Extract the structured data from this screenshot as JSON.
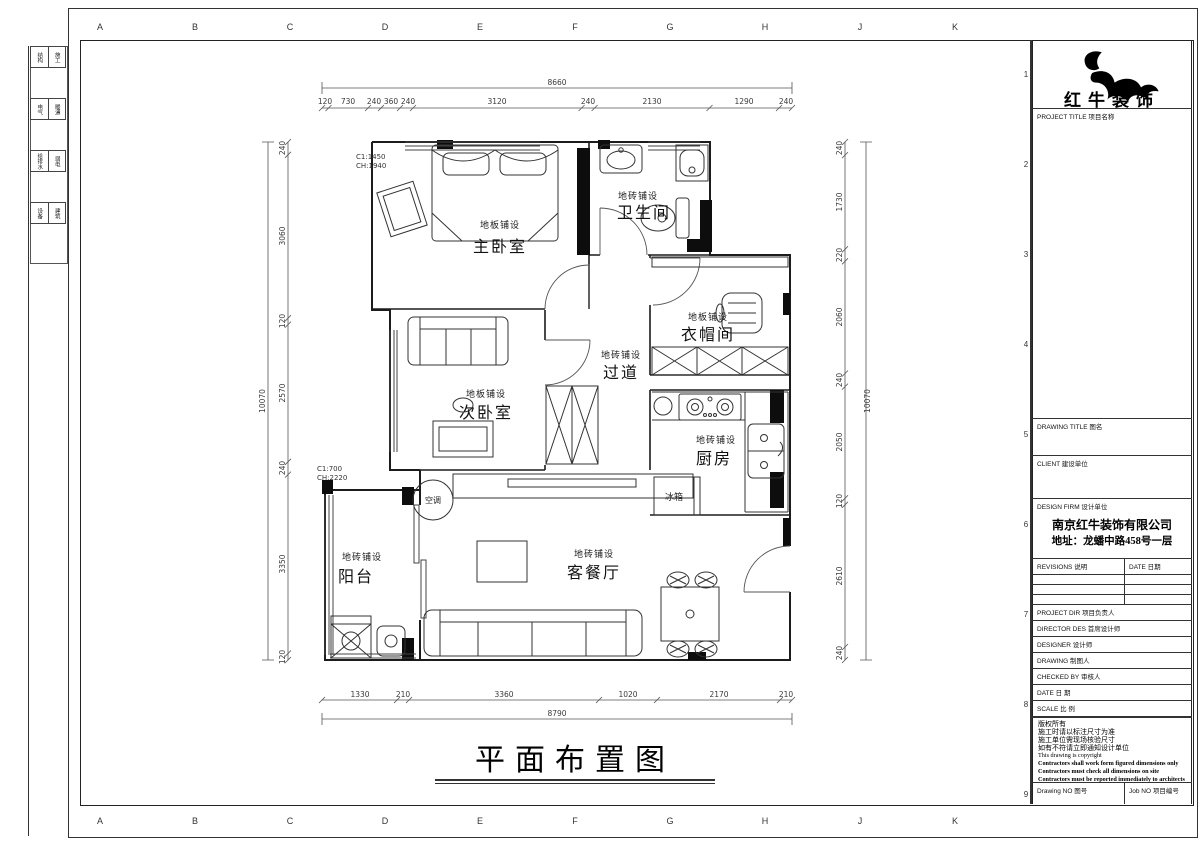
{
  "sheet": {
    "grid_letters": [
      "A",
      "B",
      "C",
      "D",
      "E",
      "F",
      "G",
      "H",
      "J",
      "K"
    ],
    "grid_numbers": [
      "1",
      "2",
      "3",
      "4",
      "5",
      "6",
      "7",
      "8",
      "9"
    ],
    "disciplines": [
      {
        "a": "结构",
        "b": "施工"
      },
      {
        "a": "电气",
        "b": "暖通"
      },
      {
        "a": "给排水",
        "b": "弱电"
      },
      {
        "a": "设备",
        "b": "建筑"
      }
    ],
    "main_title": "平面布置图"
  },
  "plan": {
    "rooms": [
      {
        "sub": "地板铺设",
        "name": "主卧室"
      },
      {
        "sub": "地砖铺设",
        "name": "卫生间"
      },
      {
        "sub": "地板铺设",
        "name": "衣帽间"
      },
      {
        "sub": "地砖铺设",
        "name": "过道"
      },
      {
        "sub": "地板铺设",
        "name": "次卧室"
      },
      {
        "sub": "地砖铺设",
        "name": "厨房"
      },
      {
        "sub": "地砖铺设",
        "name": "客餐厅"
      },
      {
        "sub": "地砖铺设",
        "name": "阳台"
      }
    ],
    "annotations": {
      "win1_line1": "C1:1450",
      "win1_line2": "CH:1940",
      "win2_line1": "C1:700",
      "win2_line2": "CH:2220",
      "ac": "空调",
      "fridge": "冰箱"
    },
    "dimensions": {
      "top_total": "8660",
      "top": [
        "120",
        "730",
        "240",
        "360",
        "240",
        "3120",
        "240",
        "2130",
        "1290",
        "240"
      ],
      "bottom": [
        "1330",
        "210",
        "3360",
        "1020",
        "2170",
        "210"
      ],
      "bottom_total": "8790",
      "left": [
        "240",
        "3060",
        "120",
        "2570",
        "240",
        "3350",
        "120"
      ],
      "left_total": "10070",
      "right": [
        "240",
        "1730",
        "220",
        "2060",
        "240",
        "2050",
        "120",
        "2610",
        "240"
      ],
      "right_total": "10070"
    }
  },
  "titleblock": {
    "brand": "红牛装饰",
    "project_title": "PROJECT TITLE 项目名称",
    "drawing_title": "DRAWING TITLE 图名",
    "client": "CLIENT 建设单位",
    "design_firm": "DESIGN FIRM 设计单位",
    "firm_name": "南京红牛装饰有限公司",
    "firm_addr": "地址：龙蟠中路458号一层",
    "revisions": "REVISIONS 说明",
    "date_col": "DATE 日期",
    "rows": [
      "PROJECT DIR 项目负责人",
      "DIRECTOR DES 首席设计师",
      "DESIGNER 设计师",
      "DRAWING 制图人",
      "CHECKED BY 审核人",
      "DATE 日 期",
      "SCALE 比 例"
    ],
    "copyright": [
      "版权所有",
      "施工时请以标注尺寸为准",
      "施工单位需现场核验尺寸",
      "如有不符请立即通知设计单位",
      "This drawing is copyright",
      "Contractors shall work form figured dimensions only",
      "Contractors must check all dimensions on site",
      "Contractors must be reported immediately to architects"
    ],
    "drawing_no": "Drawing NO 图号",
    "job_no": "Job NO 项目编号"
  }
}
